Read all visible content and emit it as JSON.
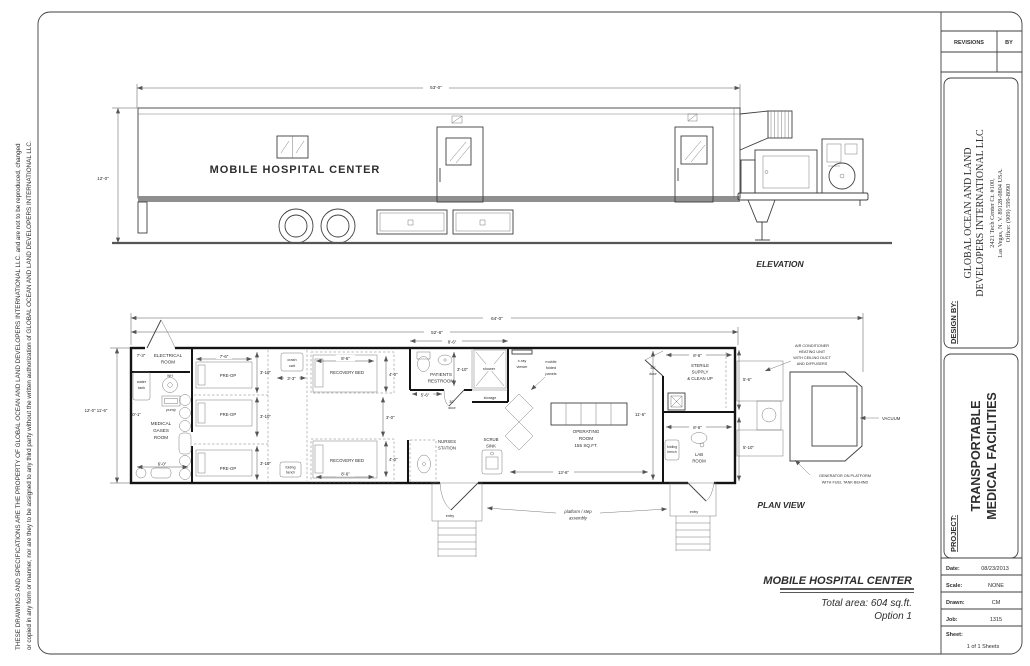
{
  "sheet": {
    "disclaimer_line1": "THESE DRAWINGS AND SPECIFICATIONS ARE THE PROPERTY OF GLOBAL OCEAN AND LAND DEVELOPERS INTERNATIONAL LLC. and are not to be reproduced, changed",
    "disclaimer_line2": "or copied in any form or manner, nor are they to be assigned to any third party without the written authorization of GLOBAL OCEAN AND LAND DEVELOPERS INTERNATIONAL LLC."
  },
  "title_block": {
    "revisions": "REVISIONS",
    "by": "BY",
    "design_by": "DESIGN BY:",
    "company": [
      "GLOBAL OCEAN AND LAND",
      "DEVELOPERS INTERNATIONAL LLC"
    ],
    "address": [
      "2421 Tech Center Ct. #100,",
      "Las Vegas, N. V. 89128-0804 USA.",
      "Office: (909) 599-8090"
    ],
    "project_label": "PROJECT:",
    "project": [
      "TRANSPORTABLE",
      "MEDICAL FACILITIES"
    ],
    "fields": {
      "date_label": "Date:",
      "date": "08/23/2013",
      "scale_label": "Scale:",
      "scale": "NONE",
      "drawn_label": "Drawn:",
      "drawn": "CM",
      "job_label": "Job:",
      "job": "1315",
      "sheet_label": "Sheet:",
      "sheet": "1 of 1 Sheets"
    }
  },
  "elevation": {
    "view_label": "ELEVATION",
    "length_dim": "53'-0\"",
    "height_dim": "12'-0\"",
    "trailer_text": "MOBILE HOSPITAL CENTER"
  },
  "plan": {
    "view_label": "PLAN VIEW",
    "dims": {
      "overall": "64'-0\"",
      "interior": "52'-6\"",
      "left_height": "12'-0\" 11'-6\"",
      "electrical_w": "7'-3\"",
      "medgas_h": "10'-1\"",
      "medgas_w": "6'-0\"",
      "preop_w": "7'-6\"",
      "preop_bed": "3'-10\"",
      "corridor_w": "3'-3\"",
      "recovery_w": "8'-6\"",
      "recovery_d": "4'-0\"",
      "recovery_gap": "3'-0\"",
      "restroom_top": "8'-6\"",
      "restroom_d": "3'-10\"",
      "restroom_w": "5'-6\"",
      "or_d": "11'-6\"",
      "or_w": "13'-6\"",
      "sterile_w": "8'-6\"",
      "sterile_d": "5'-6\"",
      "lab_w": "8'-6\"",
      "lab_d": "5'-10\""
    },
    "labels": {
      "electrical": [
        "ELECTRICAL",
        "ROOM"
      ],
      "water_tank": [
        "water",
        "tank"
      ],
      "wh": "WH",
      "pump": "pump",
      "medgas": [
        "MEDICAL",
        "GASES",
        "ROOM"
      ],
      "preop": "PRE-OP",
      "crash_cart": [
        "crash",
        "cart"
      ],
      "folding_bench": [
        "folding",
        "bench"
      ],
      "recovery": "RECOVERY BED",
      "nurses": [
        "NURSES",
        "STATION"
      ],
      "restroom": [
        "PATIENTS",
        "RESTROOM"
      ],
      "shower": "shower",
      "storage": "storage",
      "door30": [
        "30\"",
        "door"
      ],
      "scrub": [
        "SCRUB",
        "SINK"
      ],
      "xray": [
        "x-ray",
        "viewer"
      ],
      "panels": [
        "mobile",
        "folded",
        "panels"
      ],
      "operating": [
        "OPERATING",
        "ROOM",
        "155 SQ.FT."
      ],
      "sterile": [
        "STERILE",
        "SUPPLY",
        "& CLEAN UP"
      ],
      "lab": [
        "LAB",
        "ROOM"
      ],
      "entry": "entry",
      "platform": [
        "platform / step",
        "assembly"
      ],
      "ac": [
        "AIR CONDITIONER",
        "HEATING UNIT",
        "WITH CEILING DUCT",
        "AND DIFFUSERS"
      ],
      "vacuum": "VACUUM",
      "generator": [
        "GENERATOR ON PLATFORM",
        "WITH FUEL TANK BEHIND"
      ]
    }
  },
  "footer": {
    "title": "MOBILE HOSPITAL CENTER",
    "area": "Total area: 604 sq.ft.",
    "option": "Option 1"
  },
  "colors": {
    "line": "#3f3f3f",
    "wall": "#141414",
    "trailer_text": "#a3a3a3"
  }
}
